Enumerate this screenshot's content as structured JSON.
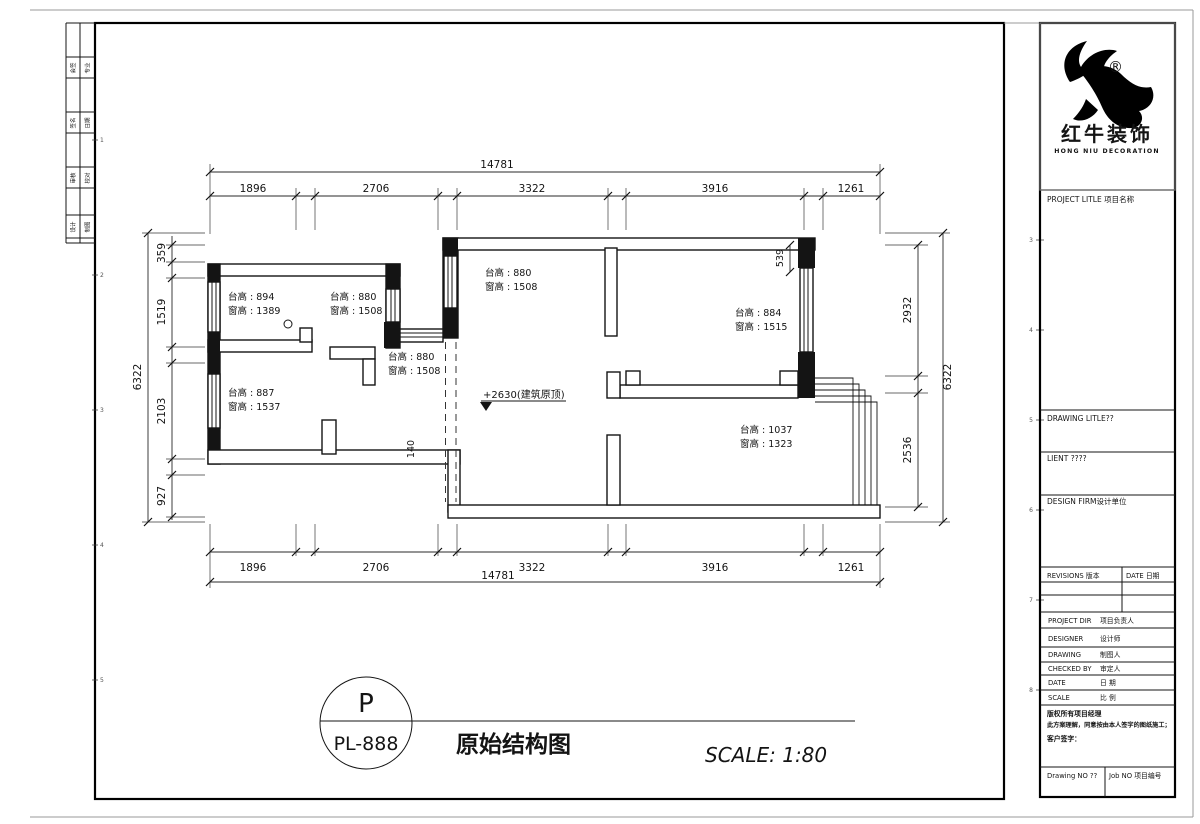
{
  "sheet": {
    "strip_pairs": [
      [
        "会签",
        "专业"
      ],
      [
        "签名",
        "日期"
      ],
      [
        "审核",
        "校对"
      ],
      [
        "设计",
        "制图"
      ]
    ],
    "left_marks": [
      "1",
      "2",
      "3",
      "4",
      "5"
    ],
    "gutter_marks": [
      "3",
      "4",
      "5",
      "6",
      "7",
      "8"
    ]
  },
  "plan": {
    "rooms": [
      {
        "l1": "台高 : 894",
        "l2": "窗高 : 1389"
      },
      {
        "l1": "台高 : 880",
        "l2": "窗高 : 1508"
      },
      {
        "l1": "台高 : 880",
        "l2": "窗高 : 1508"
      },
      {
        "l1": "台高 : 880",
        "l2": "窗高 : 1508"
      },
      {
        "l1": "台高 : 884",
        "l2": "窗高 : 1515"
      },
      {
        "l1": "台高 : 1037",
        "l2": "窗高 : 1323"
      },
      {
        "l1": "台高 : 887",
        "l2": "窗高 : 1537"
      }
    ],
    "level_mark": "+2630(建筑原顶)",
    "dims": {
      "top_total": "14781",
      "top_segments": [
        "1896",
        "2706",
        "3322",
        "3916",
        "1261"
      ],
      "bottom_total": "14781",
      "bottom_segments": [
        "1896",
        "2706",
        "3322",
        "3916",
        "1261"
      ],
      "left_total": "6322",
      "left_segments": [
        "359",
        "1519",
        "2103",
        "927"
      ],
      "right_total": "6322",
      "right_segments": [
        "2932",
        "2536"
      ],
      "offset_539": "539",
      "offset_140": "140"
    }
  },
  "title_bar": {
    "emblem_top": "P",
    "emblem_code": "PL-888",
    "drawing_name": "原始结构图",
    "scale_text": "SCALE: 1:80"
  },
  "title_block": {
    "registered": "®",
    "brand_cn": "红牛装饰",
    "brand_en": "HONG NIU DECORATION",
    "project_title": "PROJECT LITLE 项目名称",
    "drawing_title": "DRAWING LITLE??",
    "client": "LIENT ????",
    "design_firm": "DESIGN FIRM设计单位",
    "revisions_header": "REVISIONS 版本",
    "date_header": "DATE 日期",
    "rows": [
      {
        "en": "PROJECT DIR",
        "cn": "项目负责人"
      },
      {
        "en": "DESIGNER",
        "cn": "设计师"
      },
      {
        "en": "DRAWING",
        "cn": "制图人"
      },
      {
        "en": "CHECKED BY",
        "cn": "审定人"
      },
      {
        "en": "DATE",
        "cn": "日 期"
      },
      {
        "en": "SCALE",
        "cn": "比 例"
      }
    ],
    "copyright_1": "版权所有项目经理",
    "copyright_2": "此方案理解，同意按由本人签字的图纸施工；",
    "customer_sign": "客户签字：",
    "drawing_no": "Drawing NO ??",
    "job_no": "Job NO 项目编号"
  }
}
